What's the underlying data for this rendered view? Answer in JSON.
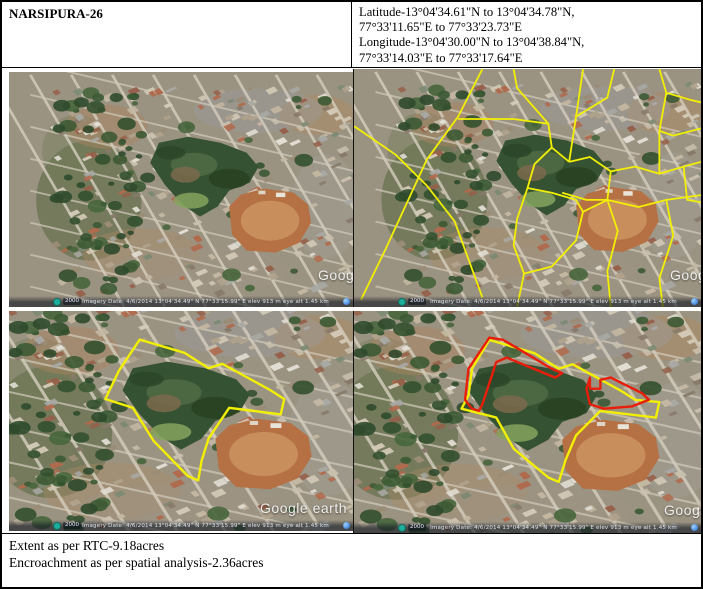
{
  "header": {
    "site_name": "NARSIPURA-26",
    "coords": [
      "Latitude-13°04'34.61\"N to 13°04'34.78\"N,",
      "77°33'11.65\"E to 77°33'23.73\"E",
      "Longitude-13°04'30.00\"N to 13°04'38.84\"N,",
      "77°33'14.03\"E to 77°33'17.64\"E"
    ]
  },
  "footer": {
    "extent_line": "Extent as per RTC-9.18acres",
    "encroachment_line": "Encroachment as per spatial analysis-2.36acres"
  },
  "map_common": {
    "watermark": "Google earth",
    "status_text": "Imagery Date: 4/6/2014    13°04'34.49\" N   77°33'15.99\" E   elev   913 m   eye alt  1.45 km",
    "scale_label": "2000"
  },
  "colors": {
    "boundary_yellow": "#f2ef04",
    "encroachment_red": "#e81d0a"
  },
  "panels": [
    {
      "id": "satellite-plain",
      "caption": "plain imagery",
      "view": {
        "tx": 13,
        "ty": 8,
        "s": 0.85
      },
      "overlays": []
    },
    {
      "id": "satellite-cadastral",
      "caption": "imagery with village map overlay",
      "view": {
        "tx": 13,
        "ty": 8,
        "s": 0.85
      },
      "overlays": [
        {
          "type": "polyline",
          "color": "#f2ef04",
          "w": 1.8,
          "points": [
            [
              37,
              0
            ],
            [
              30,
              20
            ],
            [
              21,
              38
            ],
            [
              9,
              76
            ],
            [
              2,
              97
            ]
          ]
        },
        {
          "type": "polyline",
          "color": "#f2ef04",
          "w": 1.8,
          "points": [
            [
              0,
              24
            ],
            [
              12,
              36
            ],
            [
              21,
              49
            ],
            [
              29,
              64
            ],
            [
              37,
              96
            ]
          ]
        },
        {
          "type": "polyline",
          "color": "#f2ef04",
          "w": 1.8,
          "points": [
            [
              30,
              21
            ],
            [
              46,
              21
            ],
            [
              56,
              23
            ]
          ]
        },
        {
          "type": "polyline",
          "color": "#f2ef04",
          "w": 1.8,
          "points": [
            [
              46,
              0
            ],
            [
              47,
              8
            ],
            [
              56,
              23
            ],
            [
              57,
              33
            ],
            [
              62,
              39
            ]
          ]
        },
        {
          "type": "polyline",
          "color": "#f2ef04",
          "w": 1.8,
          "points": [
            [
              66,
              0
            ],
            [
              64,
              20
            ],
            [
              62,
              39
            ]
          ]
        },
        {
          "type": "polyline",
          "color": "#f2ef04",
          "w": 1.8,
          "points": [
            [
              75,
              0
            ],
            [
              73,
              12
            ],
            [
              64,
              20
            ]
          ]
        },
        {
          "type": "polyline",
          "color": "#f2ef04",
          "w": 1.8,
          "points": [
            [
              62,
              39
            ],
            [
              68,
              37
            ],
            [
              74,
              43
            ],
            [
              81,
              41
            ],
            [
              88,
              44
            ],
            [
              95,
              41
            ],
            [
              100,
              39
            ]
          ]
        },
        {
          "type": "polyline",
          "color": "#f2ef04",
          "w": 1.8,
          "points": [
            [
              88,
              0
            ],
            [
              90,
              10
            ],
            [
              97,
              13
            ],
            [
              100,
              14
            ]
          ]
        },
        {
          "type": "polyline",
          "color": "#f2ef04",
          "w": 1.8,
          "points": [
            [
              90,
              10
            ],
            [
              88,
              26
            ],
            [
              88,
              44
            ]
          ]
        },
        {
          "type": "polyline",
          "color": "#f2ef04",
          "w": 1.8,
          "points": [
            [
              100,
              25
            ],
            [
              92,
              28
            ],
            [
              88,
              26
            ]
          ]
        },
        {
          "type": "polyline",
          "color": "#f2ef04",
          "w": 1.8,
          "points": [
            [
              95,
              41
            ],
            [
              96,
              55
            ],
            [
              100,
              56
            ]
          ]
        },
        {
          "type": "polyline",
          "color": "#f2ef04",
          "w": 1.8,
          "points": [
            [
              74,
              43
            ],
            [
              73,
              55
            ]
          ]
        },
        {
          "type": "polyline",
          "color": "#f2ef04",
          "w": 1.8,
          "points": [
            [
              60,
              52
            ],
            [
              67,
              55
            ],
            [
              73,
              55
            ],
            [
              82,
              58
            ],
            [
              90,
              55
            ],
            [
              100,
              53
            ]
          ]
        },
        {
          "type": "polyline",
          "color": "#f2ef04",
          "w": 1.8,
          "points": [
            [
              73,
              55
            ],
            [
              76,
              68
            ],
            [
              73,
              85
            ],
            [
              74,
              100
            ]
          ]
        },
        {
          "type": "polyline",
          "color": "#f2ef04",
          "w": 1.8,
          "points": [
            [
              90,
              55
            ],
            [
              92,
              70
            ],
            [
              88,
              88
            ],
            [
              89,
              100
            ]
          ]
        },
        {
          "type": "polyline",
          "color": "#f2ef04",
          "w": 1.8,
          "points": [
            [
              57,
              33
            ],
            [
              52,
              40
            ],
            [
              50,
              50
            ]
          ]
        },
        {
          "type": "polyline",
          "color": "#f2ef04",
          "w": 1.8,
          "points": [
            [
              47,
              63
            ],
            [
              50,
              50
            ],
            [
              57,
              52
            ],
            [
              64,
              55
            ],
            [
              66,
              60
            ],
            [
              64,
              72
            ],
            [
              57,
              83
            ],
            [
              49,
              86
            ],
            [
              46,
              74
            ],
            [
              47,
              63
            ]
          ]
        },
        {
          "type": "polyline",
          "color": "#f2ef04",
          "w": 1.8,
          "points": [
            [
              49,
              86
            ],
            [
              47,
              100
            ]
          ]
        },
        {
          "type": "polyline",
          "color": "#f2ef04",
          "w": 1.8,
          "points": [
            [
              66,
              60
            ],
            [
              73,
              55
            ]
          ]
        }
      ]
    },
    {
      "id": "satellite-extent",
      "caption": "imagery with tank boundary as per RTC",
      "view": {
        "tx": 0,
        "ty": 0,
        "s": 1
      },
      "overlays": [
        {
          "type": "polygon",
          "color": "#f2ef04",
          "w": 2.4,
          "points": [
            [
              38,
              13
            ],
            [
              51,
              19
            ],
            [
              58,
              26
            ],
            [
              62,
              24
            ],
            [
              69,
              30
            ],
            [
              76,
              36
            ],
            [
              80,
              40
            ],
            [
              79,
              47
            ],
            [
              64,
              44
            ],
            [
              58,
              58
            ],
            [
              56,
              68
            ],
            [
              55,
              77
            ],
            [
              52,
              75
            ],
            [
              42,
              59
            ],
            [
              36,
              44
            ],
            [
              28,
              40
            ],
            [
              32,
              27
            ],
            [
              38,
              13
            ]
          ]
        }
      ]
    },
    {
      "id": "satellite-encroachment",
      "caption": "imagery with boundary and encroachment",
      "view": {
        "tx": 0,
        "ty": 0,
        "s": 1
      },
      "overlays": [
        {
          "type": "polygon",
          "color": "#f2ef04",
          "w": 2.4,
          "points": [
            [
              39,
              13
            ],
            [
              52,
              19
            ],
            [
              59,
              26
            ],
            [
              63,
              24
            ],
            [
              70,
              30
            ],
            [
              77,
              36
            ],
            [
              81,
              40
            ],
            [
              88,
              41
            ],
            [
              87,
              48
            ],
            [
              71,
              45
            ],
            [
              64,
              56
            ],
            [
              61,
              67
            ],
            [
              59,
              77
            ],
            [
              56,
              75
            ],
            [
              46,
              62
            ],
            [
              41,
              48
            ],
            [
              31,
              44
            ],
            [
              33,
              38
            ],
            [
              34,
              26
            ],
            [
              39,
              13
            ]
          ]
        },
        {
          "type": "polygon",
          "color": "#e81d0a",
          "w": 2.4,
          "points": [
            [
              34,
              44
            ],
            [
              32,
              40
            ],
            [
              33,
              26
            ],
            [
              39,
              12
            ],
            [
              43,
              13
            ],
            [
              57,
              26
            ],
            [
              60,
              28
            ],
            [
              58,
              30
            ],
            [
              44,
              21
            ],
            [
              41,
              23
            ],
            [
              37,
              42
            ],
            [
              36,
              45
            ]
          ]
        },
        {
          "type": "polygon",
          "color": "#e81d0a",
          "w": 2.4,
          "points": [
            [
              68,
              30
            ],
            [
              68,
              35
            ],
            [
              71,
              35
            ],
            [
              71,
              31
            ],
            [
              74,
              30
            ],
            [
              83,
              37
            ],
            [
              85,
              40
            ],
            [
              80,
              43
            ],
            [
              72,
              44
            ],
            [
              68,
              42
            ],
            [
              67,
              35
            ]
          ]
        }
      ]
    }
  ]
}
